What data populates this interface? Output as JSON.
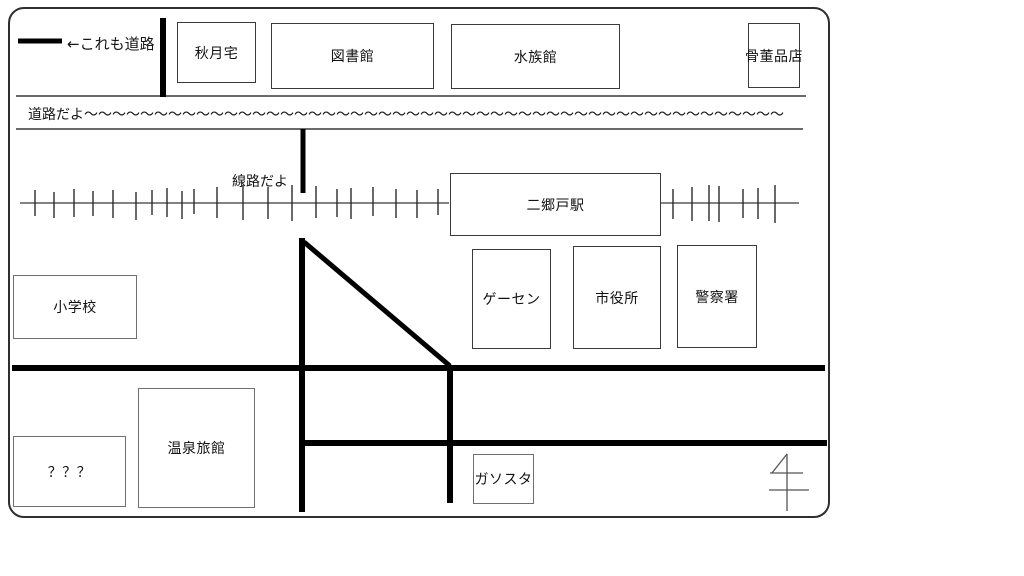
{
  "texts": {
    "legend": "←これも道路",
    "road": "道路だよ～～～～～～～～～～～～～～～～～～～～～～～～～～～～～～～～～～～～～～～～～～～～～～～～～～",
    "rail": "線路だよ"
  },
  "buildings": [
    {
      "label": "秋月宅",
      "x": 177,
      "y": 22,
      "w": 79,
      "h": 61,
      "tone": "dark"
    },
    {
      "label": "図書館",
      "x": 271,
      "y": 23,
      "w": 163,
      "h": 66,
      "tone": "dark"
    },
    {
      "label": "水族館",
      "x": 451,
      "y": 24,
      "w": 169,
      "h": 65,
      "tone": "dark"
    },
    {
      "label": "骨董品店",
      "x": 748,
      "y": 23,
      "w": 52,
      "h": 65,
      "tone": "dark"
    },
    {
      "label": "二郷戸駅",
      "x": 450,
      "y": 173,
      "w": 211,
      "h": 63,
      "tone": "dark"
    },
    {
      "label": "ゲーセン",
      "x": 472,
      "y": 249,
      "w": 79,
      "h": 100,
      "tone": "dark"
    },
    {
      "label": "市役所",
      "x": 573,
      "y": 246,
      "w": 88,
      "h": 103,
      "tone": "dark"
    },
    {
      "label": "警察署",
      "x": 677,
      "y": 245,
      "w": 80,
      "h": 103,
      "tone": "dark"
    },
    {
      "label": "小学校",
      "x": 13,
      "y": 275,
      "w": 124,
      "h": 64,
      "tone": "gray"
    },
    {
      "label": "？？？",
      "x": 13,
      "y": 436,
      "w": 113,
      "h": 71,
      "tone": "gray"
    },
    {
      "label": "温泉旅館",
      "x": 138,
      "y": 388,
      "w": 117,
      "h": 120,
      "tone": "gray"
    },
    {
      "label": "ガソスタ",
      "x": 473,
      "y": 454,
      "w": 61,
      "h": 50,
      "tone": "gray"
    }
  ],
  "card": {
    "x": 8,
    "y": 7,
    "w": 822,
    "h": 511
  },
  "roads": [
    {
      "id": "legend-sample",
      "x1": 18,
      "y1": 41,
      "x2": 62,
      "y2": 41,
      "w": 5
    },
    {
      "id": "north-street-vertical",
      "x1": 163,
      "y1": 18,
      "x2": 163,
      "y2": 97,
      "w": 6
    },
    {
      "id": "station-street-stub",
      "x1": 303,
      "y1": 129,
      "x2": 303,
      "y2": 193,
      "w": 5
    },
    {
      "id": "west-avenue-vertical",
      "x1": 302,
      "y1": 238,
      "x2": 302,
      "y2": 512,
      "w": 6
    },
    {
      "id": "diagonal-road",
      "x1": 304,
      "y1": 242,
      "x2": 450,
      "y2": 366,
      "w": 5
    },
    {
      "id": "main-street-horizontal",
      "x1": 12,
      "y1": 368,
      "x2": 825,
      "y2": 368,
      "w": 6
    },
    {
      "id": "east-avenue-vertical",
      "x1": 450,
      "y1": 368,
      "x2": 450,
      "y2": 503,
      "w": 6
    },
    {
      "id": "south-street-horizontal",
      "x1": 300,
      "y1": 443,
      "x2": 827,
      "y2": 443,
      "w": 6
    }
  ],
  "thin_lines": [
    {
      "id": "road-edge-upper",
      "x1": 16,
      "y1": 96,
      "x2": 806,
      "y2": 96
    },
    {
      "id": "road-edge-lower",
      "x1": 16,
      "y1": 129,
      "x2": 803,
      "y2": 129
    }
  ],
  "railway": {
    "y": 203,
    "segments": [
      {
        "x1": 20,
        "x2": 449
      },
      {
        "x1": 661,
        "x2": 799
      }
    ],
    "ticks": [
      [
        35,
        190,
        216
      ],
      [
        54,
        192,
        218
      ],
      [
        74,
        189,
        217
      ],
      [
        93,
        191,
        216
      ],
      [
        113,
        190,
        218
      ],
      [
        136,
        192,
        220
      ],
      [
        152,
        190,
        215
      ],
      [
        167,
        188,
        217
      ],
      [
        182,
        191,
        219
      ],
      [
        194,
        189,
        214
      ],
      [
        217,
        187,
        218
      ],
      [
        243,
        185,
        220
      ],
      [
        268,
        187,
        219
      ],
      [
        292,
        185,
        221
      ],
      [
        316,
        186,
        218
      ],
      [
        337,
        189,
        217
      ],
      [
        351,
        188,
        219
      ],
      [
        373,
        187,
        216
      ],
      [
        396,
        189,
        218
      ],
      [
        417,
        190,
        218
      ],
      [
        438,
        189,
        215
      ],
      [
        673,
        189,
        219
      ],
      [
        692,
        187,
        221
      ],
      [
        709,
        185,
        221
      ],
      [
        719,
        186,
        222
      ],
      [
        743,
        189,
        218
      ],
      [
        758,
        188,
        219
      ],
      [
        775,
        185,
        223
      ]
    ]
  },
  "compass": {
    "strokes": [
      {
        "x1": 787,
        "y1": 454,
        "x2": 787,
        "y2": 511
      },
      {
        "x1": 787,
        "y1": 454,
        "x2": 772,
        "y2": 473
      },
      {
        "x1": 770,
        "y1": 473,
        "x2": 803,
        "y2": 473
      },
      {
        "x1": 769,
        "y1": 490,
        "x2": 809,
        "y2": 490
      }
    ]
  },
  "colors": {
    "road": "#000000",
    "thin_line": "#3a3a3a",
    "rail": "#5a5a5a",
    "tick": "#2a2a2a",
    "box_dark": "#3a3a3a",
    "box_gray": "#6f6f6f",
    "compass": "#555555",
    "border": "#2f2f2f",
    "background": "#ffffff"
  }
}
